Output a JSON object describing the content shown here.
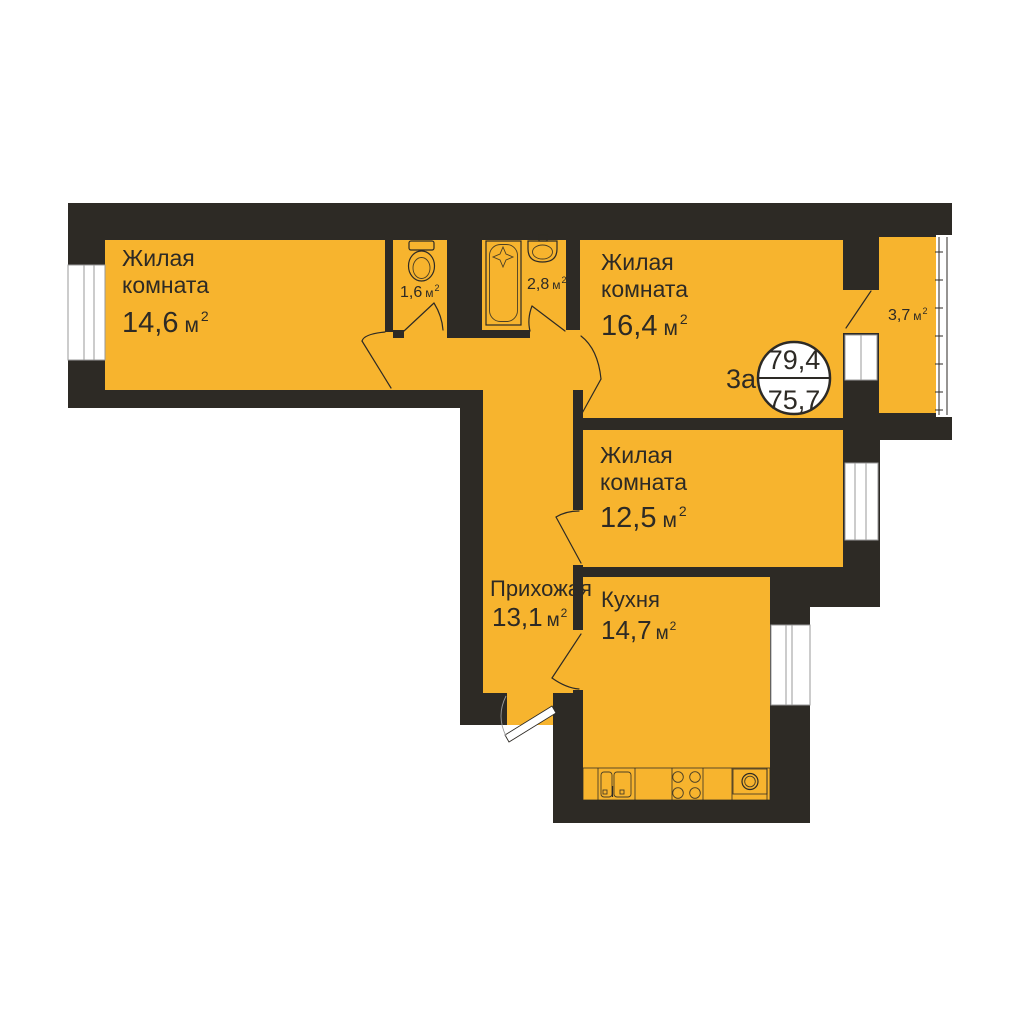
{
  "plan": {
    "type_label": "3а",
    "total_area": "79,4",
    "living_area": "75,7",
    "area_unit": "м",
    "sup": "2",
    "colors": {
      "floor": "#f7b42e",
      "wall": "#2d2a25",
      "text": "#2d2a25",
      "background": "#ffffff"
    },
    "rooms": {
      "room1": {
        "line1": "Жилая",
        "line2": "комната",
        "area": "14,6"
      },
      "wc": {
        "area": "1,6"
      },
      "bath": {
        "area": "2,8"
      },
      "room2": {
        "line1": "Жилая",
        "line2": "комната",
        "area": "16,4"
      },
      "balcony": {
        "area": "3,7"
      },
      "room3": {
        "line1": "Жилая",
        "line2": "комната",
        "area": "12,5"
      },
      "hallway": {
        "name": "Прихожая",
        "area": "13,1"
      },
      "kitchen": {
        "name": "Кухня",
        "area": "14,7"
      }
    }
  }
}
